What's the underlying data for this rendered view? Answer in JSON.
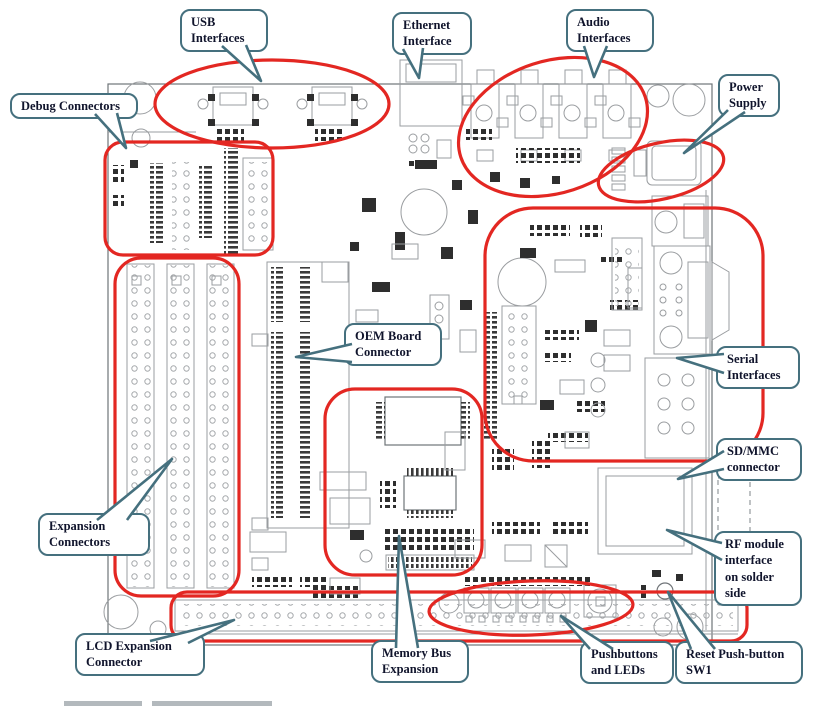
{
  "diagram": {
    "type": "annotated-board-diagram",
    "subject": "development board component layout",
    "callouts": [
      {
        "id": "usb",
        "label": "USB\nInterfaces"
      },
      {
        "id": "ethernet",
        "label": "Ethernet\nInterface"
      },
      {
        "id": "audio",
        "label": "Audio\nInterfaces"
      },
      {
        "id": "power",
        "label": "Power\nSupply"
      },
      {
        "id": "debug",
        "label": "Debug Connectors"
      },
      {
        "id": "oem",
        "label": "OEM Board\nConnector"
      },
      {
        "id": "serial",
        "label": "Serial\nInterfaces"
      },
      {
        "id": "sdmmc",
        "label": "SD/MMC\nconnector"
      },
      {
        "id": "expansion",
        "label": "Expansion\nConnectors"
      },
      {
        "id": "rf",
        "label": "RF module\ninterface\non solder\nside"
      },
      {
        "id": "lcd",
        "label": "LCD Expansion\nConnector"
      },
      {
        "id": "memory",
        "label": "Memory Bus\nExpansion"
      },
      {
        "id": "pushbuttons",
        "label": "Pushbuttons\nand LEDs"
      },
      {
        "id": "reset",
        "label": "Reset Push-button\nSW1"
      }
    ],
    "colors": {
      "highlight": "#e32722",
      "callout_border": "#45707e",
      "callout_text": "#10142c",
      "board_line": "#9a9da0"
    }
  }
}
